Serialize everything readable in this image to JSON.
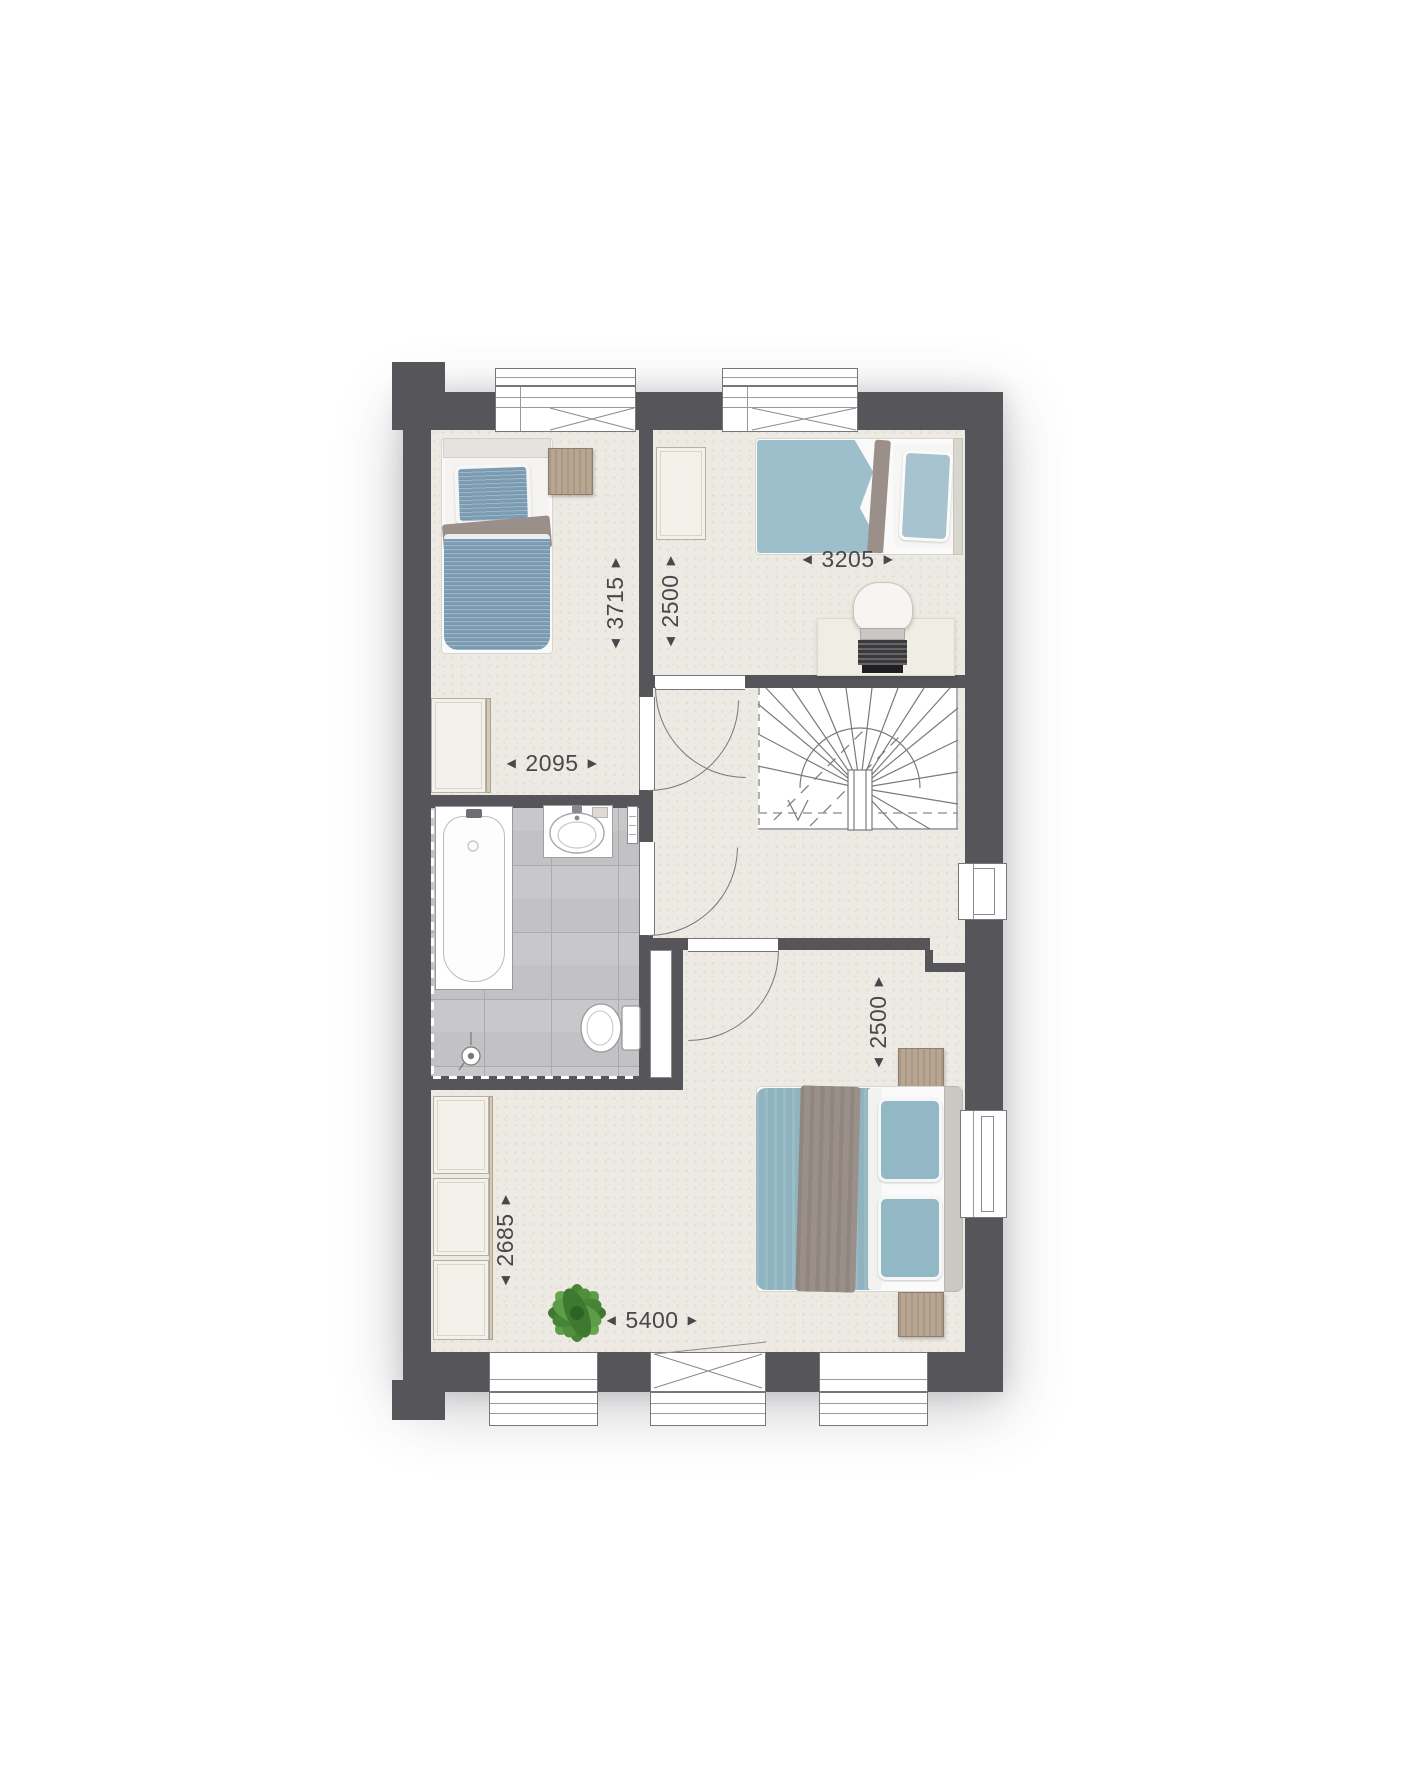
{
  "dimensions": [
    {
      "name": "bedroom1-depth",
      "value": "3715",
      "orientation": "vertical"
    },
    {
      "name": "bedroom2-depth",
      "value": "2500",
      "orientation": "vertical"
    },
    {
      "name": "bedroom2-width",
      "value": "3205",
      "orientation": "horizontal"
    },
    {
      "name": "bedroom1-width",
      "value": "2095",
      "orientation": "horizontal"
    },
    {
      "name": "master-bedroom-depth-right",
      "value": "2500",
      "orientation": "vertical"
    },
    {
      "name": "master-bedroom-depth-left",
      "value": "2685",
      "orientation": "vertical"
    },
    {
      "name": "master-bedroom-width",
      "value": "5400",
      "orientation": "horizontal"
    }
  ],
  "glyphs": {
    "arrow_left": "◀",
    "arrow_right": "▶"
  },
  "colors": {
    "wall": "#56555A",
    "floor": "#EDEAE3",
    "tile": "#C2C2C4",
    "grout": "#ABABAD",
    "line": "#77777B",
    "bed-blue": "#7C9DB4",
    "bed-teal": "#9DBFCC",
    "duvet-teal": "#8FB4BF",
    "blanket-gray": "#9A9089",
    "wood": "#B7A691",
    "plant-green": "#4E8F3B"
  }
}
